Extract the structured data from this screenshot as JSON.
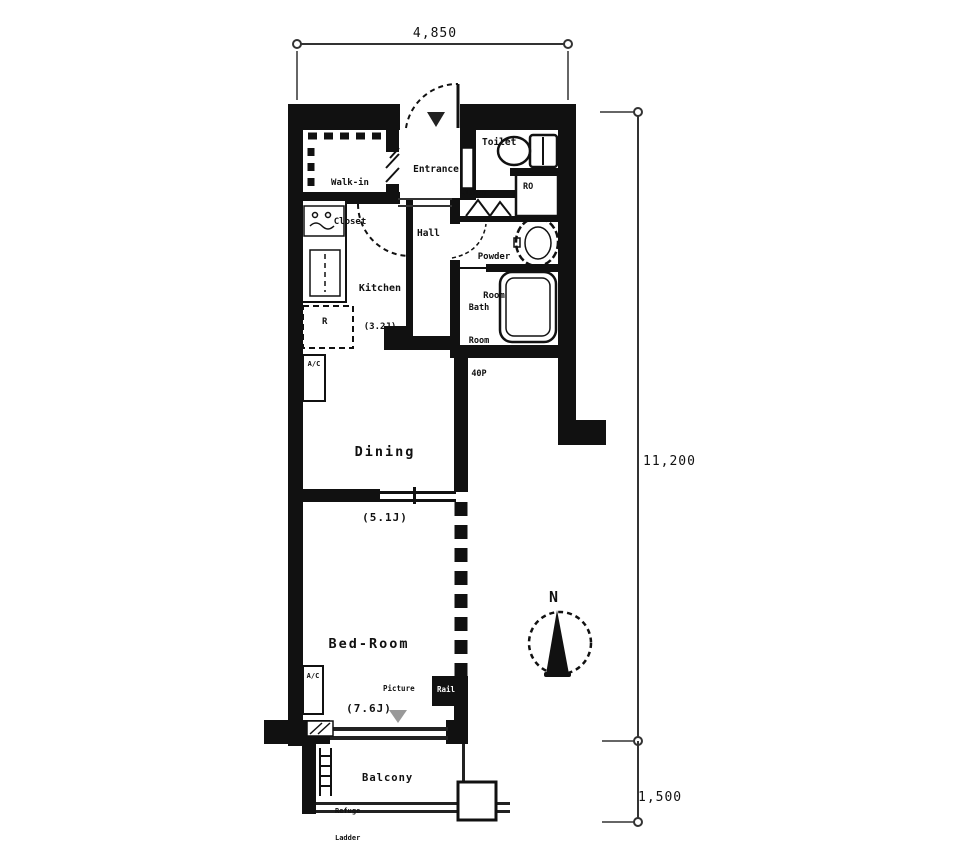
{
  "dimensions": {
    "width_top": "4,850",
    "height_main": "11,200",
    "height_balcony": "1,500"
  },
  "rooms": {
    "walk_in_closet_1": "Walk-in",
    "walk_in_closet_2": "Closet",
    "entrance": "Entrance",
    "toilet": "Toilet",
    "linen": "Linen",
    "ro": "RO",
    "powder_1": "Powder",
    "powder_2": "Room",
    "bath_1": "Bath",
    "bath_2": "Room",
    "bath_3": "40P",
    "hall": "Hall",
    "kitchen": "Kitchen",
    "kitchen_size": "(3.2J)",
    "dining": "Dining",
    "dining_size": "(5.1J)",
    "bedroom": "Bed-Room",
    "bedroom_size": "(7.6J)",
    "balcony": "Balcony",
    "picture": "Picture",
    "rail": "Rail",
    "refuge_1": "Refuge",
    "refuge_2": "Ladder",
    "fridge": "R",
    "ac": "A/C"
  },
  "compass": {
    "north": "N"
  },
  "colors": {
    "wall": "#111111",
    "line": "#333333",
    "gray_marker": "#999999"
  }
}
